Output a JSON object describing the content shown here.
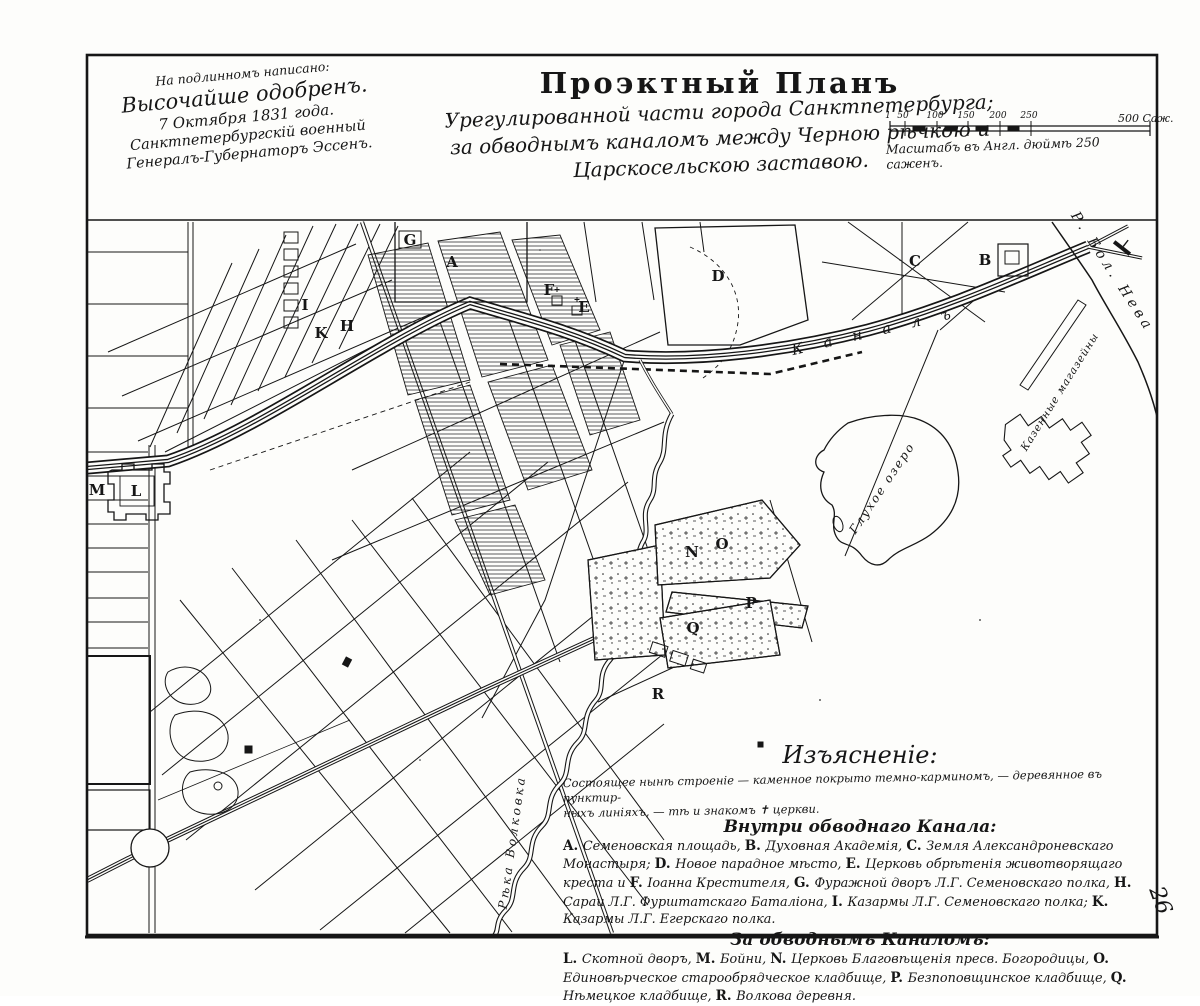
{
  "palette": {
    "paper": "#fdfdfb",
    "ink": "#161616"
  },
  "approval_note": {
    "lines": [
      "На подлинномъ написано:",
      "Высочайше одобренъ.",
      "7 Октября 1831 года.",
      "Санктпетербургскій военный",
      "Генералъ-Губернаторъ Эссенъ."
    ]
  },
  "title": {
    "main": "Проэктный Планъ",
    "subtitle_lines": [
      "Урегулированной части города Санктпетербурга;",
      "за обводнымъ каналомъ между Черною рѣчкою и",
      "Царскосельскою заставою."
    ]
  },
  "scale_bar": {
    "ticks": [
      "1",
      "50",
      "100",
      "150",
      "200",
      "250"
    ],
    "end_label": "500 Саж.",
    "caption": "Масштабъ въ Англ. дюймѣ 250 саженъ."
  },
  "map": {
    "markers": [
      {
        "letter": "A",
        "x": 452,
        "y": 263
      },
      {
        "letter": "B",
        "x": 985,
        "y": 261
      },
      {
        "letter": "C",
        "x": 915,
        "y": 262
      },
      {
        "letter": "D",
        "x": 718,
        "y": 277
      },
      {
        "letter": "E",
        "x": 584,
        "y": 308
      },
      {
        "letter": "F",
        "x": 549,
        "y": 291
      },
      {
        "letter": "G",
        "x": 410,
        "y": 241
      },
      {
        "letter": "H",
        "x": 347,
        "y": 327
      },
      {
        "letter": "I",
        "x": 305,
        "y": 306
      },
      {
        "letter": "K",
        "x": 321,
        "y": 334
      },
      {
        "letter": "L",
        "x": 136,
        "y": 492
      },
      {
        "letter": "M",
        "x": 97,
        "y": 491
      },
      {
        "letter": "N",
        "x": 692,
        "y": 553
      },
      {
        "letter": "O",
        "x": 722,
        "y": 545
      },
      {
        "letter": "P",
        "x": 751,
        "y": 604
      },
      {
        "letter": "Q",
        "x": 693,
        "y": 629
      },
      {
        "letter": "R",
        "x": 658,
        "y": 695
      }
    ],
    "labels": [
      {
        "name": "canal-label",
        "text": "К а н а л ъ",
        "x": 875,
        "y": 331,
        "rot": -13,
        "size": 15,
        "ls": 8
      },
      {
        "name": "neva-river-label",
        "text": "Р. Бол. Нева",
        "x": 1112,
        "y": 272,
        "rot": 57,
        "size": 14,
        "ls": 4
      },
      {
        "name": "glukhoe-lake-label",
        "text": "Глухое озеро",
        "x": 882,
        "y": 488,
        "rot": -56,
        "size": 12,
        "ls": 2
      },
      {
        "name": "volkovka-river-label",
        "text": "Рѣка Волковка",
        "x": 512,
        "y": 842,
        "rot": -82,
        "size": 12,
        "ls": 3
      },
      {
        "name": "warehouses-label",
        "text": "Казенные магазейны",
        "x": 1060,
        "y": 392,
        "rot": -58,
        "size": 10.5,
        "ls": 1
      }
    ]
  },
  "legend": {
    "title": "Изъясненіе:",
    "intro_lines": [
      "Состоящее нынѣ строеніе — каменное покрыто темно-карминомъ, — деревянное въ пунктир-",
      "ныхъ линіяхъ, — тѣ и знакомъ ✝ церкви."
    ],
    "sections": [
      {
        "heading": "Внутри обводнаго Канала:",
        "entries": [
          {
            "letter": "A",
            "text": "Семеновская площадь,"
          },
          {
            "letter": "B",
            "text": "Духовная Академія,"
          },
          {
            "letter": "C",
            "text": "Земля Александроневскаго Монастыря;"
          },
          {
            "letter": "D",
            "text": "Новое парадное мѣсто,"
          },
          {
            "letter": "E",
            "text": "Церковь обрѣтенія животворящаго креста и"
          },
          {
            "letter": "F",
            "text": "Іоанна Крестителя,"
          },
          {
            "letter": "G",
            "text": "Фуражной дворъ Л.Г. Семеновскаго полка,"
          },
          {
            "letter": "H",
            "text": "Сараи Л.Г. Фурштатскаго Баталіона,"
          },
          {
            "letter": "I",
            "text": "Казармы Л.Г. Семеновскаго полка;"
          },
          {
            "letter": "K",
            "text": "Казармы Л.Г. Егерскаго полка."
          }
        ]
      },
      {
        "heading": "За обводнымъ Каналомъ:",
        "entries": [
          {
            "letter": "L",
            "text": "Скотной дворъ,"
          },
          {
            "letter": "M",
            "text": "Бойни,"
          },
          {
            "letter": "N",
            "text": "Церковь Благовѣщенія пресв. Богородицы,"
          },
          {
            "letter": "O",
            "text": "Единовѣрческое старообрядческое кладбище,"
          },
          {
            "letter": "P",
            "text": "Безпоповщинское кладбище,"
          },
          {
            "letter": "Q",
            "text": "Нѣмецкое кладбище,"
          },
          {
            "letter": "R",
            "text": "Волкова деревня."
          }
        ]
      }
    ]
  },
  "page_number": "26"
}
